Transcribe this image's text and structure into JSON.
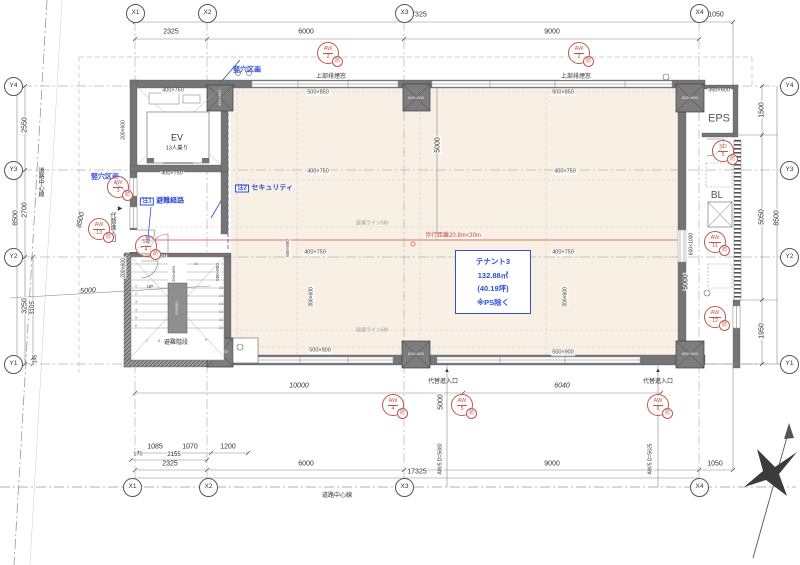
{
  "grid": {
    "x": [
      "X1",
      "X2",
      "X3",
      "X4"
    ],
    "y": [
      "Y4",
      "Y3",
      "Y2",
      "Y1"
    ]
  },
  "dims": {
    "top": {
      "d2325": "2325",
      "d6000": "6000",
      "d9000": "9000",
      "d17325": "17325",
      "d1050": "1050"
    },
    "bottom": {
      "d1085": "1085",
      "d1070": "1070",
      "d1200": "1200",
      "d170": "170",
      "d2155": "2155",
      "d2325": "2325",
      "d6000": "6000",
      "d9000": "9000",
      "d1050": "1050",
      "d17325": "17325"
    },
    "left": {
      "d2550": "2550",
      "d2700": "2700",
      "d3250": "3250",
      "d3105": "3105",
      "d145": "145",
      "d8500": "8500",
      "road8500": "8500",
      "road5000": "5000"
    },
    "right": {
      "d1500": "1500",
      "d5050": "5050",
      "d1950": "1950",
      "d8500": "8500"
    },
    "inner": {
      "v5000a": "5000",
      "v5000b": "5000",
      "v5000c": "5000",
      "d10000": "10000",
      "d6040": "6040",
      "aw5a": "AW/5 D=5680",
      "aw5b": "AW/5 D=5625"
    }
  },
  "sizes": {
    "s400750": "400×750",
    "s500850": "500×850",
    "s500900": "500×900",
    "s350600": "350×600",
    "s600600": "600×600",
    "s450850": "450×850",
    "s850800": "850×800",
    "s200600": "200×600",
    "s300600": "300×600",
    "s550850": "550×850",
    "s6001000": "600×1000",
    "s250850": "250×850"
  },
  "rooms": {
    "ev": "EV",
    "ev_cap": "13人乗り",
    "eps": "EPS",
    "bl": "BL",
    "stairs": "避難階段",
    "kw": "KW150",
    "up": "UP"
  },
  "tenant": {
    "name": "テナント3",
    "area": "132.88㎡",
    "tsubo": "(40.19坪)",
    "note": "※PS除く"
  },
  "ann": {
    "tateana": "竪穴区画",
    "n1": "注1",
    "n1t": "避難経路",
    "n2": "注2",
    "n2t": "セキュリティ",
    "walk": "歩行距離20.8m<30m",
    "ensho": "延焼ライン5M",
    "smoke": "上部排煙窓",
    "entry": "代替進入口",
    "road": "道路中心線",
    "up_arrow": "▲",
    "right_arrow": "▶"
  },
  "markers": {
    "badge": "防",
    "aw2": {
      "t": "AW",
      "n": "2"
    },
    "aw3": {
      "t": "AW",
      "n": "3"
    },
    "aw4": {
      "t": "AW",
      "n": "4"
    },
    "aw5": {
      "t": "AW",
      "n": "5"
    },
    "aw6": {
      "t": "AW",
      "n": "6"
    },
    "aw11": {
      "t": "AW",
      "n": "11"
    },
    "aw12": {
      "t": "AW",
      "n": "12"
    },
    "aw13": {
      "t": "AW",
      "n": "13"
    },
    "sd4": {
      "t": "SD",
      "n": "4"
    },
    "sd5": {
      "t": "SD",
      "n": "5"
    }
  },
  "stairs": {
    "steps": [
      "1",
      "2",
      "3",
      "4",
      "5",
      "6",
      "7",
      "8",
      "9",
      "10",
      "11",
      "12",
      "13",
      "14",
      "15",
      "16"
    ]
  },
  "colors": {
    "accent_red": "#c0564a",
    "accent_blue": "#2e4fd0",
    "walk_line": "#dc7a5f",
    "floor": "#f8efe5",
    "wall": "#757575"
  }
}
